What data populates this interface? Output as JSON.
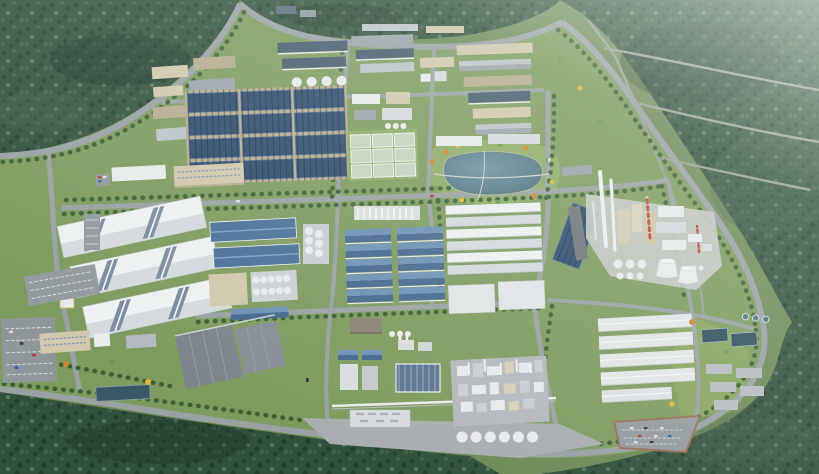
{
  "scene": {
    "type": "3d-aerial-masterplan-render",
    "subject": "industrial-park-campus-aerial-rendering",
    "regions": [
      "forest-northwest",
      "forest-northeast",
      "forest-south",
      "planned-plot-roads",
      "north-factory-cluster",
      "solar-roof-block",
      "greenhouse-block",
      "tank-farm",
      "central-lake-park",
      "logistics-warehouses-west",
      "blue-roof-warehouses-center",
      "warehouse-rows-east",
      "solar-panel-strip",
      "chemical-plant",
      "cooling-towers",
      "process-plant-south",
      "storage-tank-row",
      "water-treatment-plant",
      "warehouse-rows-southeast",
      "parking-lots",
      "office-buildings",
      "retention-pond",
      "pipe-rack",
      "perimeter-roads",
      "gatehouse"
    ]
  },
  "palette": {
    "terrain": "#6e8a58",
    "parkGrass": "#7e9b5f",
    "lawnLight": "#8dab66",
    "lawnBright": "#88a560",
    "forestBase": "#31513d",
    "forestDot1": "#22402d",
    "forestDot2": "#44634b",
    "forestDot3": "#5a785e",
    "forestShadow": "#1d3628",
    "roadMain": "#9aa1a5",
    "roadMinor": "#98a096",
    "treeLine": "#3c6134",
    "treeOrange": "#d2832f",
    "treeYellow": "#ddb53c",
    "treeGreen": "#6f9a4b",
    "roofWhiteHi": "#eef1f2",
    "roofWhiteLo": "#d5dadd",
    "roofGrayHi": "#bdc4c9",
    "roofGrayLo": "#9ba3ab",
    "roofSlate": "#44596b",
    "wallBeige": "#d1c8ad",
    "wallBeigeDark": "#b5ab8f",
    "wallWhite": "#e8eaeb",
    "gableBlueHi": "#6d90b4",
    "gableBlueLo": "#46688f",
    "steelBlue": "#4d7099",
    "solarBlue": "#2d4b6d",
    "solarFrame": "#51719a",
    "skylightBlue": "#7a8da0",
    "ribbedBlue": "#5d7490",
    "greenhouse": "#c6d4c0",
    "greenhouseFrame": "#eef2ee",
    "windowBlue": "#7d97b5",
    "lakeHi": "#6d93a0",
    "lakeLo": "#466b7a",
    "pondBlue": "#3a5766",
    "poolDark": "#2f4f5e",
    "clarifier": "#4f7486",
    "concrete": "#c6cac6",
    "apron": "#a8adb0",
    "parkingGray": "#949b9f",
    "parkingEdge": "#97705a",
    "stallWhite": "#dfe3e5",
    "tankWhite": "#e9ebec",
    "stackWhite": "#eef0f1",
    "stackRed": "#b54a34",
    "gateTrim": "#c9b668",
    "carRed": "#b03a2e",
    "carBlue": "#2e5fa3",
    "carWhite": "#dcdfe1",
    "carDark": "#2f3338",
    "haze": "#e9f2ea"
  }
}
